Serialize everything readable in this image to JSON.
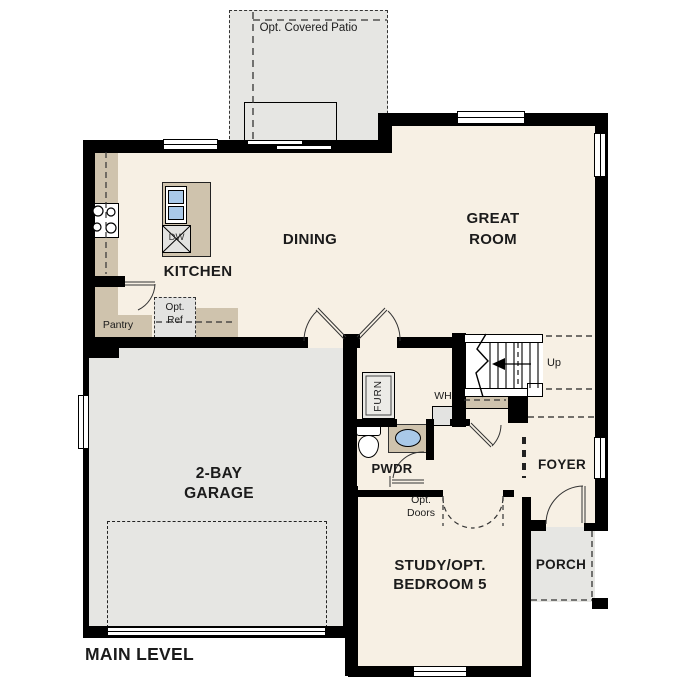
{
  "plan": {
    "title": "MAIN LEVEL",
    "rooms": {
      "patio": "Opt. Covered Patio",
      "dining": "DINING",
      "great_room": [
        "GREAT",
        "ROOM"
      ],
      "kitchen": "KITCHEN",
      "pantry": "Pantry",
      "garage": [
        "2-BAY",
        "GARAGE"
      ],
      "powder": "PWDR",
      "foyer": "FOYER",
      "porch": "PORCH",
      "study": [
        "STUDY/OPT.",
        "BEDROOM 5"
      ]
    },
    "fixtures": {
      "dishwasher": "DW",
      "refrigerator": [
        "Opt.",
        "Ref"
      ],
      "furnace": "FURN",
      "water_heater": "WH",
      "opt_doors": [
        "Opt.",
        "Doors"
      ],
      "stairs_direction": "Up"
    },
    "colors": {
      "wall": "#000000",
      "floor": "#f7f0e4",
      "garage_floor": "#e6e6e3",
      "counter": "#cfc3ad",
      "sink": "#a9c9e9",
      "fixture_gray": "#e3e3e1"
    }
  }
}
